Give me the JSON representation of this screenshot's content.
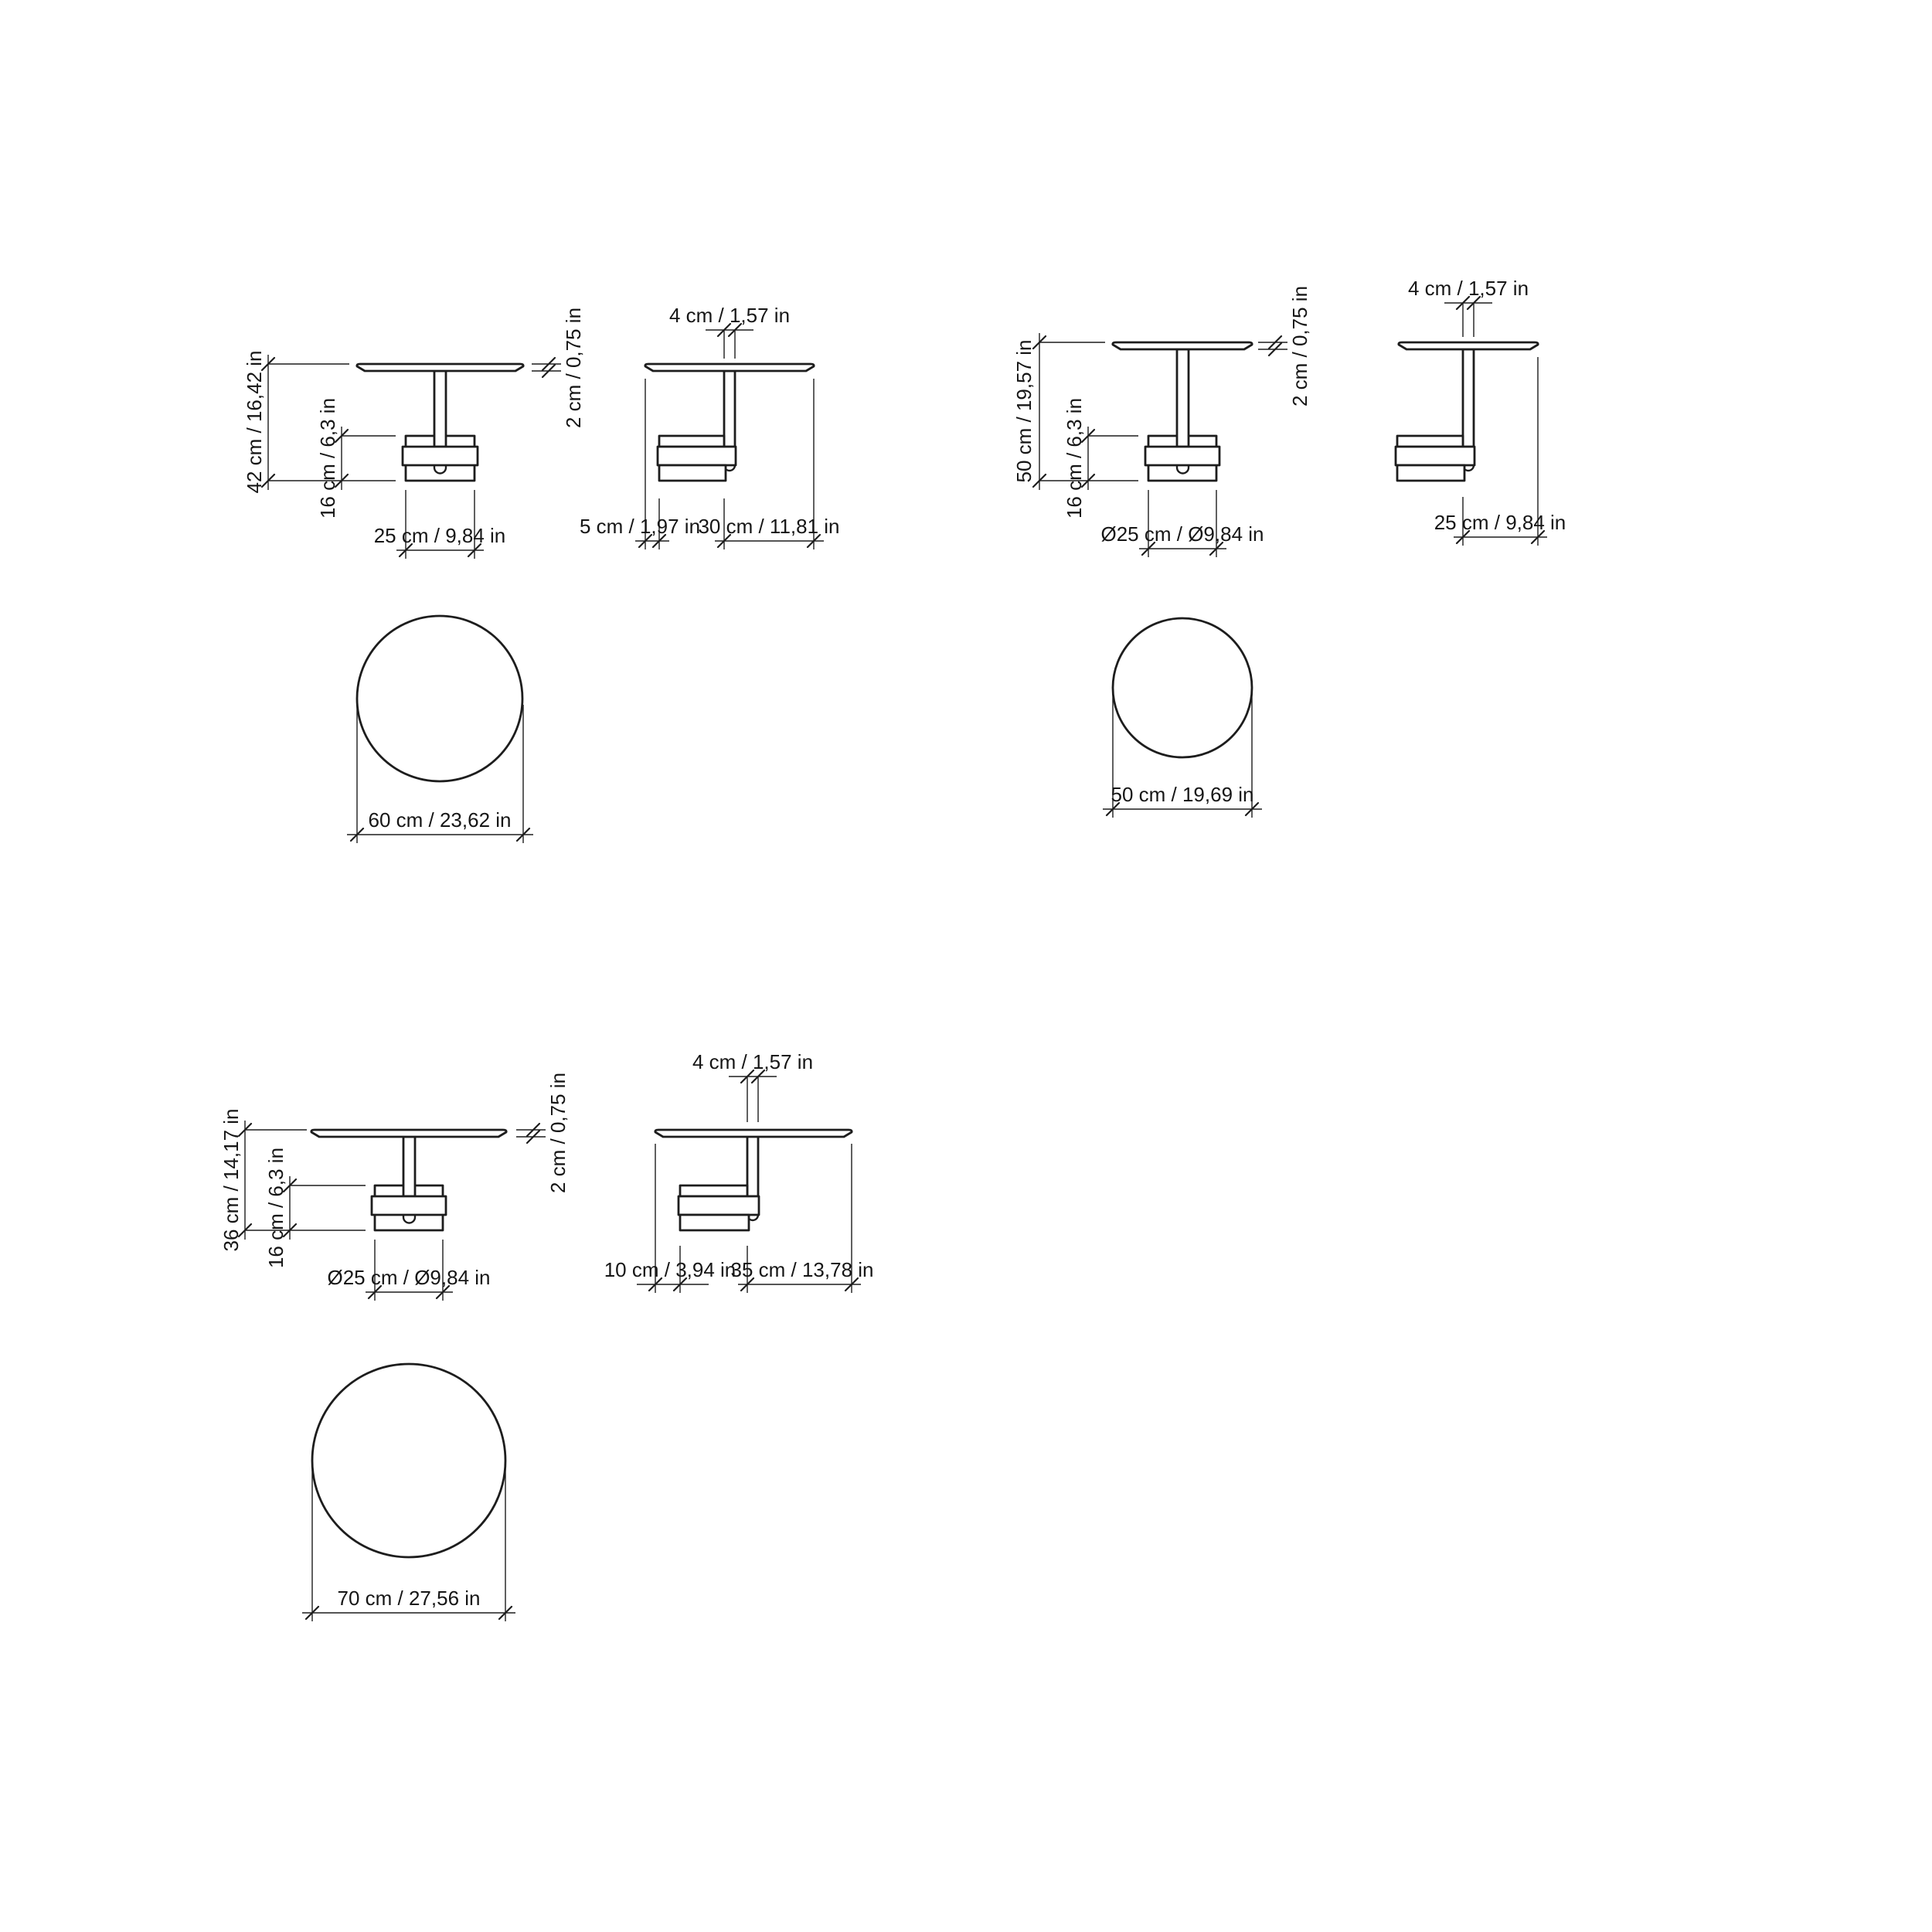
{
  "drawing": {
    "background": "#ffffff",
    "line_color": "#1d1d1d",
    "tables": [
      {
        "name": "side-table-60",
        "front": {
          "height": "42 cm / 16,42 in",
          "base_height": "16 cm / 6,3 in",
          "base_width": "25 cm / 9,84 in",
          "top_thickness": "2 cm / 0,75 in"
        },
        "side": {
          "stem_width": "4 cm / 1,57 in",
          "left_offset": "5 cm / 1,97 in",
          "right_offset": "30 cm / 11,81 in"
        },
        "top": {
          "diameter": "60 cm / 23,62 in"
        }
      },
      {
        "name": "side-table-50",
        "front": {
          "height": "50 cm / 19,57 in",
          "base_height": "16 cm / 6,3 in",
          "base_width": "Ø25 cm / Ø9,84 in",
          "top_thickness": "2 cm / 0,75 in"
        },
        "side": {
          "stem_width": "4 cm / 1,57 in",
          "right_offset": "25 cm / 9,84 in"
        },
        "top": {
          "diameter": "50 cm / 19,69 in"
        }
      },
      {
        "name": "side-table-70",
        "front": {
          "height": "36 cm / 14,17 in",
          "base_height": "16 cm / 6,3 in",
          "base_width": "Ø25 cm / Ø9,84 in",
          "top_thickness": "2 cm / 0,75 in"
        },
        "side": {
          "stem_width": "4 cm / 1,57 in",
          "left_offset": "10 cm / 3,94 in",
          "right_offset": "35 cm / 13,78 in"
        },
        "top": {
          "diameter": "70 cm / 27,56 in"
        }
      }
    ]
  }
}
